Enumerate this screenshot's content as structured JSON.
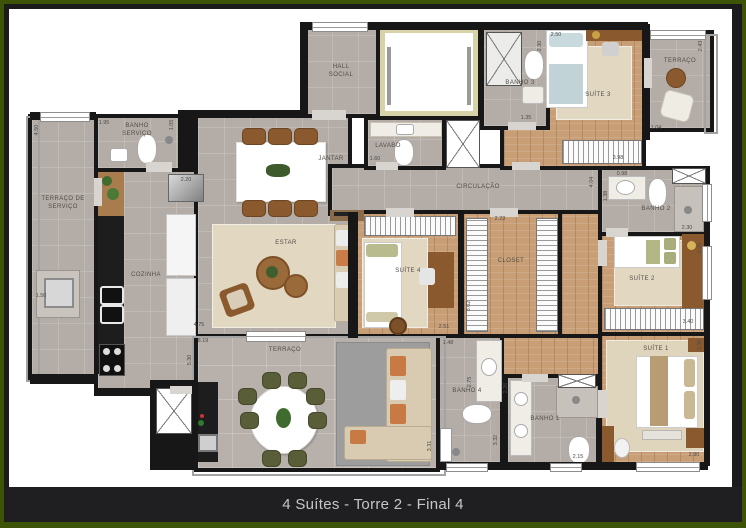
{
  "caption": {
    "text": "4 Suítes - Torre 2 - Final 4"
  },
  "colors": {
    "frame_green": "#3d5407",
    "frame_dark": "#1b1b1e",
    "caption_bg": "#1f1f22",
    "caption_text": "#c6c6c6",
    "wall": "#171717",
    "floor_gray": "#b4ada7",
    "floor_wood": "#c89e76",
    "rug_beige": "#e2d8c2",
    "furniture_wood": "#8a5a2e"
  },
  "rooms": {
    "hall": {
      "label": "HALL\nSOCIAL"
    },
    "banho_servico": {
      "label": "BANHO\nSERVIÇO"
    },
    "terraco_servico": {
      "label": "TERRAÇO DE\nSERVIÇO"
    },
    "cozinha": {
      "label": "COZINHA"
    },
    "jantar": {
      "label": "JANTAR"
    },
    "estar": {
      "label": "ESTAR"
    },
    "lavabo": {
      "label": "LAVABO"
    },
    "circulacao": {
      "label": "CIRCULAÇÃO"
    },
    "banho3": {
      "label": "BANHO 3"
    },
    "suite3": {
      "label": "SUÍTE 3"
    },
    "terraco_sup": {
      "label": "TERRAÇO"
    },
    "banho2": {
      "label": "BANHO 2"
    },
    "suite2": {
      "label": "SUÍTE 2"
    },
    "suite4": {
      "label": "SUÍTE 4"
    },
    "closet": {
      "label": "CLOSET"
    },
    "suite1": {
      "label": "SUÍTE 1"
    },
    "banho1": {
      "label": "BANHO 1"
    },
    "banho4": {
      "label": "BANHO 4"
    },
    "terraco_inf": {
      "label": "TERRAÇO"
    }
  },
  "dims": [
    "4.50",
    "1.95",
    "1.05",
    "2.20",
    "1.50",
    "5.30",
    "4.75",
    "8.19",
    "2.50",
    "2.30",
    "3.98",
    "1.35",
    "1.04",
    "2.43",
    "1.60",
    "2.23",
    "2.51",
    "3.02",
    "0.98",
    "4.04",
    "1.38",
    "2.30",
    "3.40",
    "2.25",
    "3.35",
    "2.90",
    "1.48",
    "3.32",
    "2.26",
    "2.15",
    "3.31",
    "2.75"
  ]
}
